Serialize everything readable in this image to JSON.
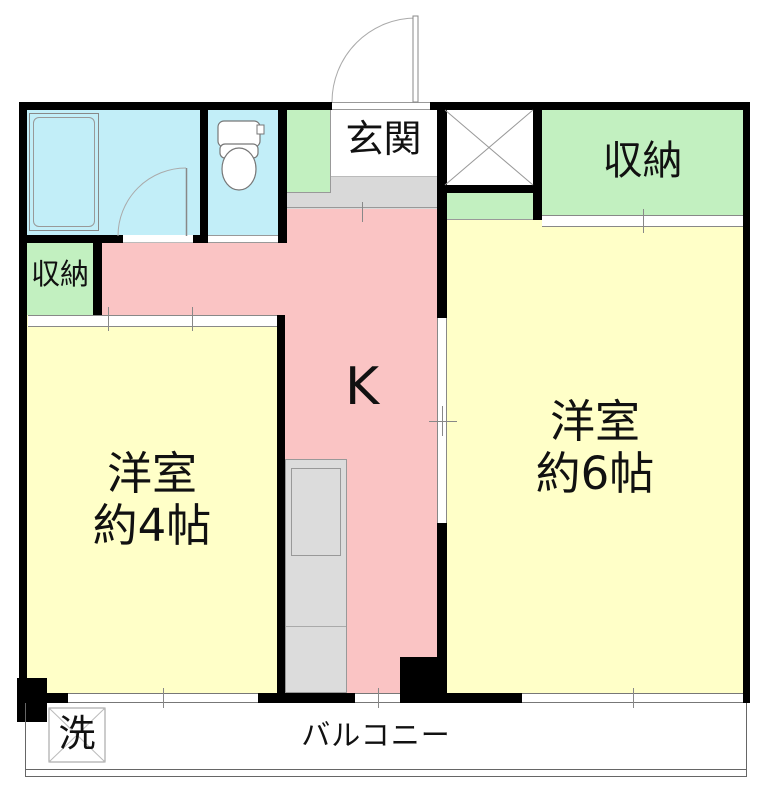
{
  "plan_title": "1DK apartment floor plan",
  "colors": {
    "wall": "#000000",
    "room_yellow": "#FFFFC8",
    "kitchen_pink": "#FAC4C4",
    "storage_green": "#C2F0C0",
    "bath_cyan": "#C2EEF8",
    "counter_gray": "#DCDCDC",
    "step_gray": "#D9D9D9"
  },
  "rooms": {
    "entrance": {
      "label": "玄関"
    },
    "storage_right": {
      "label": "収納"
    },
    "storage_left": {
      "label": "収納"
    },
    "western_room_4": {
      "name_label": "洋室",
      "size_label": "約4帖"
    },
    "western_room_6": {
      "name_label": "洋室",
      "size_label": "約6帖"
    },
    "kitchen": {
      "label": "K"
    },
    "balcony": {
      "label": "バルコニー"
    },
    "laundry": {
      "label": "洗"
    }
  }
}
